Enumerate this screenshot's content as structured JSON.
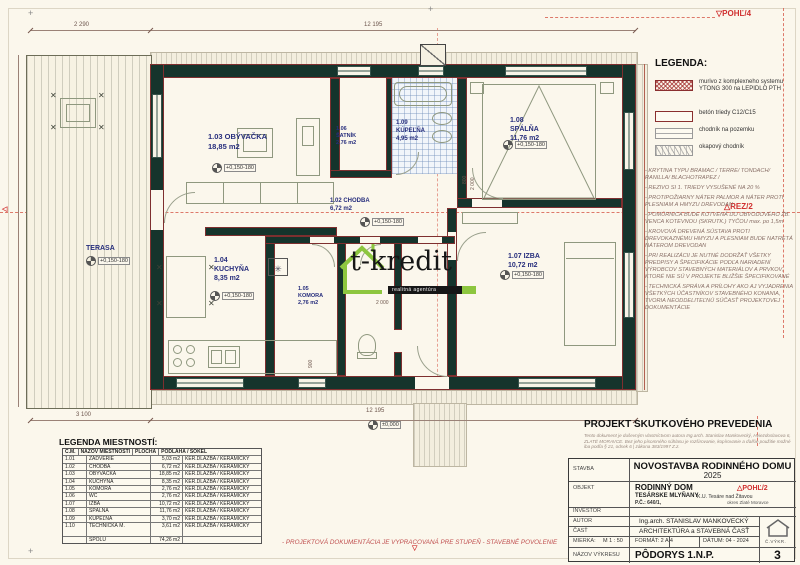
{
  "colors": {
    "wall": "#15342c",
    "accent_red": "#d03030",
    "label_blue": "#272e7d",
    "logo_green": "#8dc63f"
  },
  "icons": {
    "section_down": "▽",
    "section_tri": "△",
    "section_left": "◁",
    "flue_star": "✳",
    "chair_x": "✕",
    "cross_mark": "+"
  },
  "marks": {
    "pohl4": "POHĽ/4",
    "rez2": "REZ/2"
  },
  "elevation": "+0,150-180",
  "dims": {
    "top_left": "2 290",
    "top_main": "12 195",
    "bottom_left": "3 100",
    "bottom_main": "12 195",
    "zero": "±0,000",
    "d800": "800",
    "d2000": "2 000",
    "d900": "900"
  },
  "rooms": {
    "obyvacka": {
      "title": "1.03 OBÝVAČKA",
      "area": "18,85 m2"
    },
    "satnik": {
      "num": "1.06",
      "name": "ŠATNÍK",
      "area": "2,76 m2"
    },
    "kupelna": {
      "num": "1.09",
      "name": "KÚPEĽŇA",
      "area": "4,95 m2"
    },
    "spalna": {
      "num": "1.08",
      "name": "SPÁLŇA",
      "area": "11,76 m2"
    },
    "chodba": {
      "title": "1.02 CHODBA",
      "area": "6,72 m2"
    },
    "izba": {
      "title": "1.07 IZBA",
      "area": "10,72 m2"
    },
    "kuchyna": {
      "num": "1.04",
      "name": "KUCHYŇA",
      "area": "8,35 m2"
    },
    "komora": {
      "num": "1.05",
      "name": "KOMORA",
      "area": "2,76 m2"
    },
    "terasa": {
      "name": "TERASA"
    }
  },
  "logo": {
    "name": "t-kredit",
    "tagline": "realitná agentúra"
  },
  "legend": {
    "title": "LEGENDA:",
    "items": [
      {
        "label": "murivo z komplexneho systemu YTONG 300 na LEPIDLO PTH"
      },
      {
        "label": "betón triedy C12/C15"
      },
      {
        "label": "chodník na pozemku"
      },
      {
        "label": "okapový chodník"
      }
    ]
  },
  "notes": [
    "- KRYTINA TYPU BRAMAC / TERRE/ TONDACH/ RANILLA/ BLACHOTRAPEZ /",
    "- REZIVO SI 1. TRIEDY VYSUŠENÉ NA 20 %",
    "- PROTIPOŽIARNY NÁTER PALMOR A NÁTER PROTI PLESNIAM A HMYZU DREVODAN",
    "- POMÚRNICA BUDE KOTVENÁ DO OBVODOVÉHO ŽB. VENCA KOTEVNOU (SKRUTK.) TYČOU max. po 1,5m",
    "- KROVOVÁ DREVENÁ SÚSTAVA PROTI DREVOKAZNÉMU HMYZU A PLESNIAM BUDE NATRETÁ NÁTEROM DREVODAN",
    "- PRI REALIZÁCII JE NUTNÉ DODRŽAŤ VŠETKY PREDPISY A ŠPECIFIKÁCIE PODĽA NARIADENÍ VÝROBCOV STAVEBNÝCH MATERIÁLOV A PRVKOV, KTORÉ NIE SÚ V PROJEKTE BLIŽŠIE ŠPECIFIKOVANÉ",
    "- TECHNICKÁ SPRÁVA A PRÍLOHY AKO AJ VYJADRENIA VŠETKÝCH ÚČASTNÍKOV STAVEBNÉHO KONANIA, TVORIA NEODDELITEĽNÚ SÚČASŤ PROJEKTOVEJ DOKUMENTÁCIE"
  ],
  "room_table": {
    "title": "LEGENDA MIESTNOSTÍ:",
    "headers": [
      "Č.M.",
      "NÁZOV MIESTNOSTI",
      "PLOCHA",
      "PODLAHA / SOKEL"
    ],
    "rows": [
      {
        "cm": "1.01",
        "nazov": "ZÁDVERIE",
        "plocha": "5,03 m2",
        "podlaha": "KER.DLAŽBA / KERAMICKÝ"
      },
      {
        "cm": "1.02",
        "nazov": "CHODBA",
        "plocha": "6,72 m2",
        "podlaha": "KER.DLAŽBA / KERAMICKÝ"
      },
      {
        "cm": "1.03",
        "nazov": "OBÝVAČKA",
        "plocha": "18,85 m2",
        "podlaha": "KER.DLAŽBA / KERAMICKÝ"
      },
      {
        "cm": "1.04",
        "nazov": "KUCHYŇA",
        "plocha": "8,35 m2",
        "podlaha": "KER.DLAŽBA / KERAMICKÝ"
      },
      {
        "cm": "1.05",
        "nazov": "KOMORA",
        "plocha": "2,76 m2",
        "podlaha": "KER.DLAŽBA / KERAMICKÝ"
      },
      {
        "cm": "1.06",
        "nazov": "WC",
        "plocha": "2,76 m2",
        "podlaha": "KER.DLAŽBA / KERAMICKÝ"
      },
      {
        "cm": "1.07",
        "nazov": "IZBA",
        "plocha": "10,72 m2",
        "podlaha": "KER.DLAŽBA / KERAMICKÝ"
      },
      {
        "cm": "1.08",
        "nazov": "SPÁLŇA",
        "plocha": "11,76 m2",
        "podlaha": "KER.DLAŽBA / KERAMICKÝ"
      },
      {
        "cm": "1.09",
        "nazov": "KÚPEĽŇA",
        "plocha": "3,70 m2",
        "podlaha": "KER.DLAŽBA / KERAMICKÝ"
      },
      {
        "cm": "1.10",
        "nazov": "TECHNICKÁ M.",
        "plocha": "3,61 m2",
        "podlaha": "KER.DLAŽBA / KERAMICKÝ"
      }
    ],
    "total_label": "SPOLU",
    "total_value": "74,26 m2"
  },
  "title_block": {
    "heading": "PROJEKT SKUTKOVÉHO PREVEDENIA",
    "copyright": "Tento dokument je duševným vlastníctvom autora Ing.arch. Stanislav Mankovecký, Hviezdoslavova 6, ZLATÉ MORAVCE. Bez jeho písomného súhlasu je rozširovanie, kopírovanie a ďalšie použitie možné iba podľa § 21, odsek 6 | zákona 383/1997 Z.z.",
    "stavba_label": "STAVBA",
    "stavba": "NOVOSTAVBA RODINNÉHO DOMU",
    "year": "2025",
    "objekt_label": "OBJEKT",
    "objekt": "RODINNÝ DOM",
    "pohl2": "POHĽ/2",
    "loc1": "TESÁRSKE MLYŇANY",
    "loc2": "K.U. Tesáre nad Žitavou",
    "loc3": "P.Č.: 640/1,",
    "loc4": "okres Zlaté Moravce",
    "investor_label": "INVESTOR",
    "autor_label": "AUTOR",
    "autor": "Ing.arch. STANISLAV MANKOVECKÝ",
    "cast_label": "ČASŤ",
    "cast": "ARCHITEKTÚRA a STAVEBNÁ ČASŤ",
    "mierka_label": "MIERKA:",
    "mierka": "M 1 : 50",
    "format": "FORMÁT:  2 A 4",
    "datum": "DÁTUM:  04 - 2024",
    "cvykr_label": "Č.VÝKR.",
    "nazov_label": "NÁZOV VÝKRESU",
    "nazov": "PÔDORYS 1.N.P.",
    "number": "3"
  },
  "footer_note": "- PROJEKTOVÁ DOKUMENTÁCIA JE VYPRACOVANÁ PRE STUPEŇ - STAVEBNÉ POVOLENIE"
}
